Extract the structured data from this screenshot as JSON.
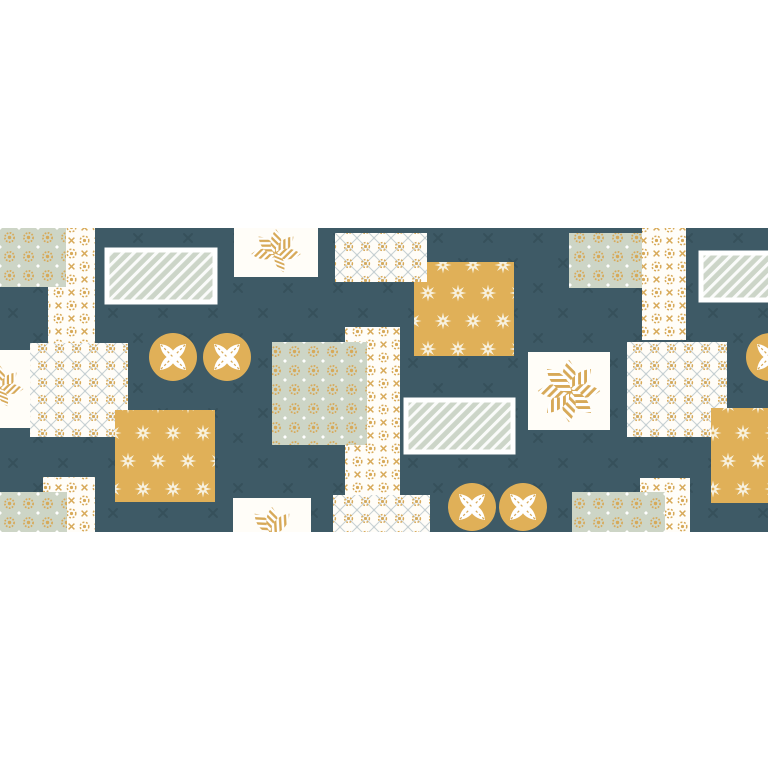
{
  "canvas": {
    "width": 768,
    "height": 768
  },
  "band": {
    "x": 0,
    "y": 228,
    "w": 768,
    "h": 304
  },
  "palette": {
    "white": "#fffdf8",
    "teal": "#3e5a66",
    "tealdark": "#344e59",
    "sage": "#cdd5c6",
    "gold": "#d7a958",
    "mustard": "#e0b058",
    "cream": "#f7f0dd",
    "stripebg": "#ccd5c8",
    "latticeline": "#c6d0d3",
    "pagebg": "#ffffff"
  },
  "artwork": {
    "patches": [
      {
        "name": "band-background",
        "shape": "rect",
        "pattern": "bgx",
        "x": 0,
        "y": 228,
        "w": 768,
        "h": 304
      },
      {
        "name": "white-floral-strip-top-left",
        "shape": "rect",
        "pattern": "whiteflower",
        "x": 48,
        "y": 228,
        "w": 47,
        "h": 117
      },
      {
        "name": "sage-dot-patch-top-left",
        "shape": "rect",
        "pattern": "sageflower",
        "x": 0,
        "y": 228,
        "w": 66,
        "h": 59
      },
      {
        "name": "striped-rect-top-left",
        "shape": "rect",
        "pattern": "stripes",
        "border": true,
        "x": 107,
        "y": 250,
        "w": 108,
        "h": 52
      },
      {
        "name": "leaf-square-top",
        "shape": "motif",
        "motif": "leafcluster",
        "x": 234,
        "y": 228,
        "w": 84,
        "h": 49,
        "mx": 42,
        "my": 26,
        "scale": 0.95
      },
      {
        "name": "mustard-star-patch-top",
        "shape": "rect",
        "pattern": "mustardstar",
        "x": 414,
        "y": 262,
        "w": 100,
        "h": 94
      },
      {
        "name": "lattice-patch-top",
        "shape": "rect",
        "pattern": "lattice",
        "x": 335,
        "y": 233,
        "w": 92,
        "h": 49
      },
      {
        "name": "sage-dot-patch-top-right",
        "shape": "rect",
        "pattern": "sageflower",
        "x": 569,
        "y": 233,
        "w": 96,
        "h": 55
      },
      {
        "name": "white-floral-strip-top-right",
        "shape": "rect",
        "pattern": "whiteflower",
        "x": 642,
        "y": 228,
        "w": 44,
        "h": 112
      },
      {
        "name": "striped-rect-top-right",
        "shape": "rect",
        "pattern": "stripes",
        "border": true,
        "x": 701,
        "y": 253,
        "w": 92,
        "h": 47
      },
      {
        "name": "white-leaf-square-left-edge",
        "shape": "motif",
        "motif": "leafcluster",
        "x": 0,
        "y": 350,
        "w": 43,
        "h": 78,
        "mx": 0,
        "my": 39,
        "scale": 0.9
      },
      {
        "name": "lattice-patch-left",
        "shape": "rect",
        "pattern": "lattice",
        "x": 30,
        "y": 343,
        "w": 98,
        "h": 94
      },
      {
        "name": "white-floral-strip-center",
        "shape": "rect",
        "pattern": "whiteflower",
        "x": 345,
        "y": 327,
        "w": 55,
        "h": 168
      },
      {
        "name": "sage-dot-patch-center",
        "shape": "rect",
        "pattern": "sageflower",
        "x": 272,
        "y": 342,
        "w": 95,
        "h": 103
      },
      {
        "name": "mustard-star-patch-left",
        "shape": "rect",
        "pattern": "mustardstar",
        "x": 115,
        "y": 410,
        "w": 100,
        "h": 92
      },
      {
        "name": "striped-rect-center",
        "shape": "rect",
        "pattern": "stripes",
        "border": true,
        "x": 406,
        "y": 400,
        "w": 107,
        "h": 52
      },
      {
        "name": "snowflake-square-center-right",
        "shape": "motif",
        "motif": "starflower",
        "x": 528,
        "y": 352,
        "w": 82,
        "h": 78,
        "mx": 41,
        "my": 39,
        "scale": 1.2
      },
      {
        "name": "lattice-patch-right",
        "shape": "rect",
        "pattern": "lattice",
        "x": 627,
        "y": 342,
        "w": 100,
        "h": 95
      },
      {
        "name": "mustard-star-patch-right",
        "shape": "rect",
        "pattern": "mustardstar",
        "x": 711,
        "y": 408,
        "w": 90,
        "h": 95
      },
      {
        "name": "white-floral-strip-bottom-left",
        "shape": "rect",
        "pattern": "whiteflower",
        "x": 43,
        "y": 477,
        "w": 52,
        "h": 55
      },
      {
        "name": "sage-dot-patch-bottom-left",
        "shape": "rect",
        "pattern": "sageflower",
        "x": 0,
        "y": 492,
        "w": 67,
        "h": 40
      },
      {
        "name": "leaf-square-bottom",
        "shape": "motif",
        "motif": "leaftrio",
        "x": 233,
        "y": 498,
        "w": 78,
        "h": 34,
        "mx": 39,
        "my": 35,
        "scale": 1
      },
      {
        "name": "lattice-patch-bottom",
        "shape": "rect",
        "pattern": "lattice",
        "x": 333,
        "y": 495,
        "w": 97,
        "h": 37
      },
      {
        "name": "white-floral-strip-bottom-right",
        "shape": "rect",
        "pattern": "whiteflower",
        "x": 640,
        "y": 478,
        "w": 50,
        "h": 54
      },
      {
        "name": "sage-dot-patch-bottom-right",
        "shape": "rect",
        "pattern": "sageflower",
        "x": 572,
        "y": 492,
        "w": 93,
        "h": 40
      },
      {
        "name": "leaf-medallion-1",
        "shape": "circle",
        "motif": "leafcircle",
        "cx": 173,
        "cy": 357
      },
      {
        "name": "leaf-medallion-2",
        "shape": "circle",
        "motif": "leafcircle",
        "cx": 227,
        "cy": 357
      },
      {
        "name": "leaf-medallion-right-edge",
        "shape": "circle",
        "motif": "leafcircle",
        "cx": 770,
        "cy": 357
      },
      {
        "name": "leaf-medallion-3",
        "shape": "circle",
        "motif": "leafcircle",
        "cx": 472,
        "cy": 507
      },
      {
        "name": "leaf-medallion-4",
        "shape": "circle",
        "motif": "leafcircle",
        "cx": 523,
        "cy": 507
      }
    ]
  }
}
